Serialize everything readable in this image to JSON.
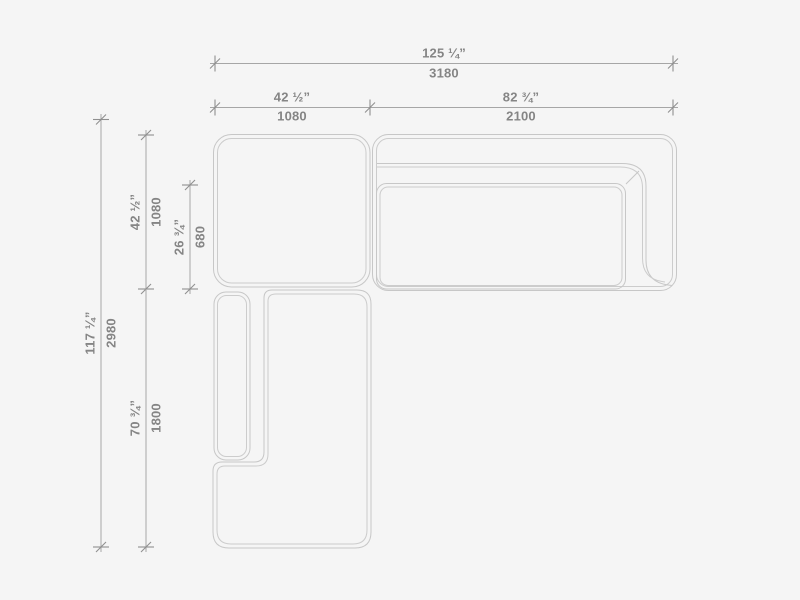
{
  "drawing": {
    "kind": "sectional-sofa-plan-view",
    "colors": {
      "background": "#f5f5f5",
      "furniture_line": "#c7c7c7",
      "dimension_line": "#a6a6a6",
      "tick": "#8f8f8f",
      "text": "#858585"
    },
    "dimensions": {
      "top_total": {
        "inches": "125 ¼”",
        "mm": "3180"
      },
      "top_left": {
        "inches": "42 ½”",
        "mm": "1080"
      },
      "top_right": {
        "inches": "82 ¾”",
        "mm": "2100"
      },
      "left_total": {
        "inches": "117 ¼”",
        "mm": "2980"
      },
      "left_upper": {
        "inches": "42 ½”",
        "mm": "1080"
      },
      "left_inner": {
        "inches": "26 ¾”",
        "mm": "680"
      },
      "left_lower": {
        "inches": "70 ¾”",
        "mm": "1800"
      }
    }
  }
}
